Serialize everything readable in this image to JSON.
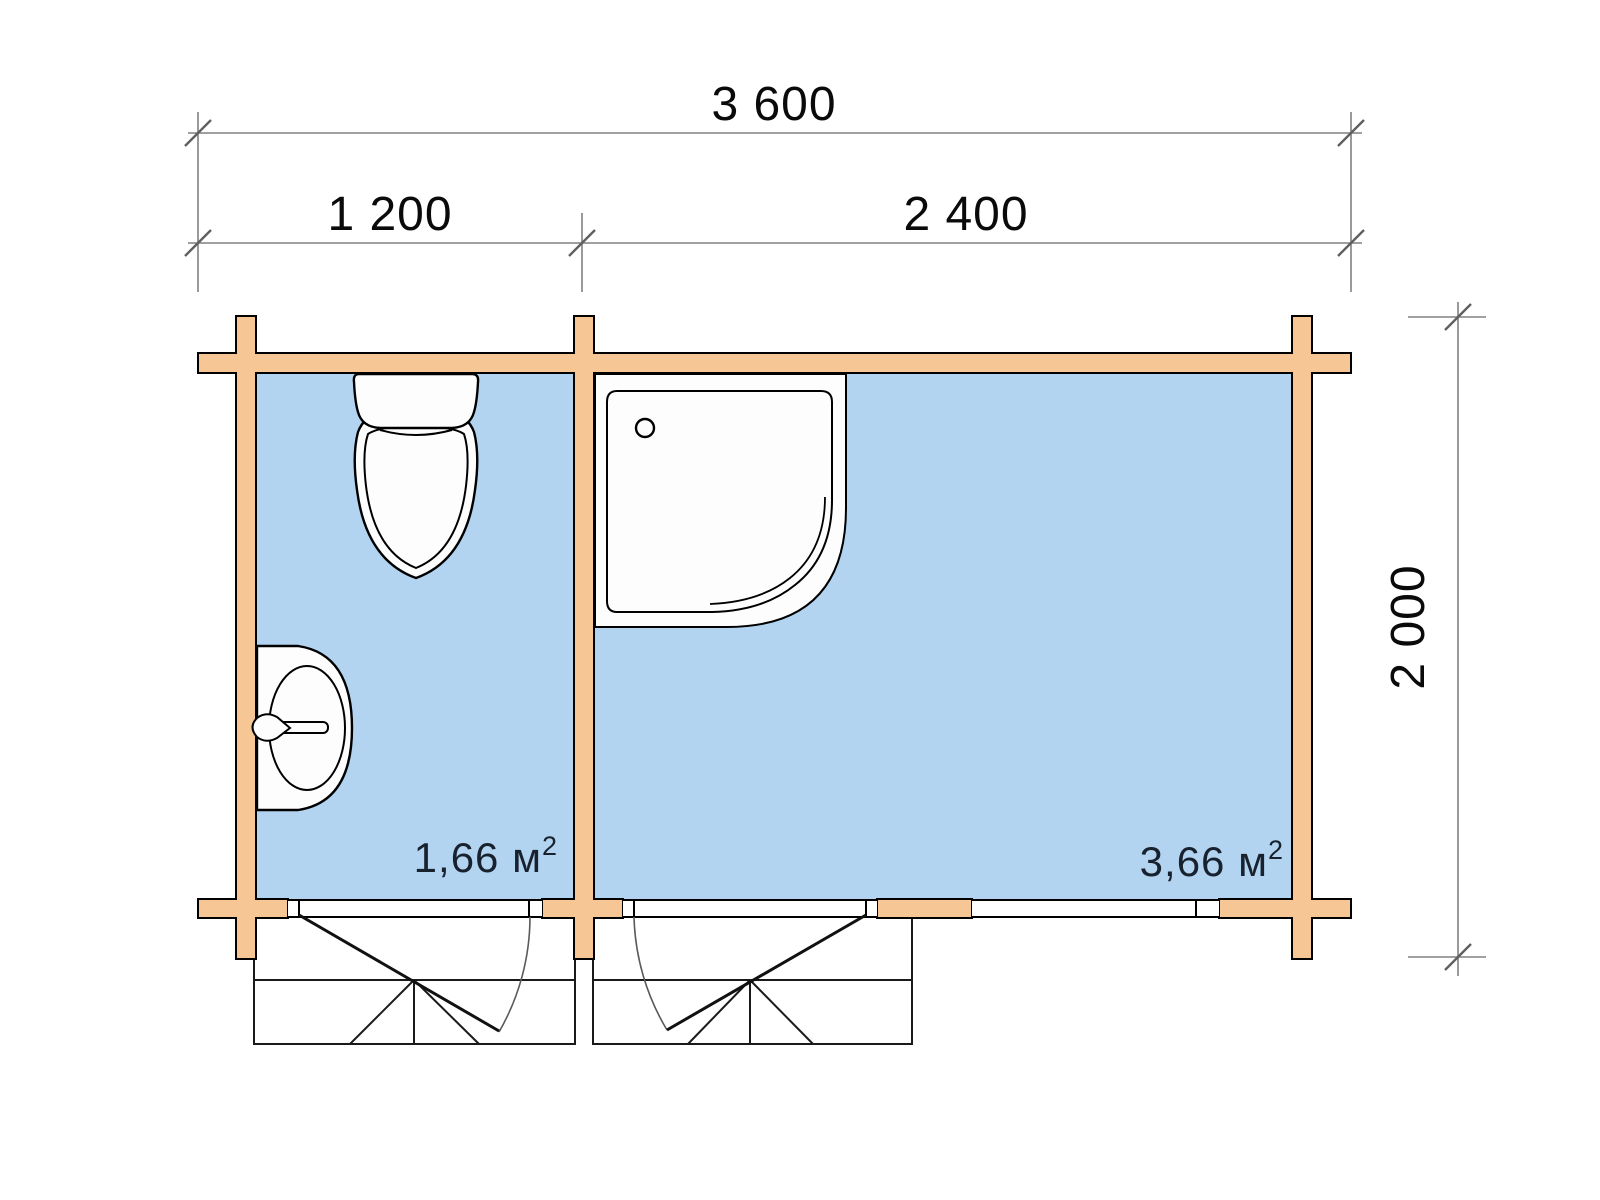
{
  "dimensions": {
    "total_width_mm": "3 600",
    "left_section_mm": "1 200",
    "right_section_mm": "2 400",
    "depth_mm": "2 000"
  },
  "rooms": [
    {
      "area": "1,66 м",
      "area_sup": "2"
    },
    {
      "area": "3,66 м",
      "area_sup": "2"
    }
  ],
  "colors": {
    "wall_fill": "#F7C695",
    "floor_fill": "#B2D4F1",
    "outline": "#000000",
    "dimension_line": "#808080",
    "area_label": "#18222E"
  }
}
